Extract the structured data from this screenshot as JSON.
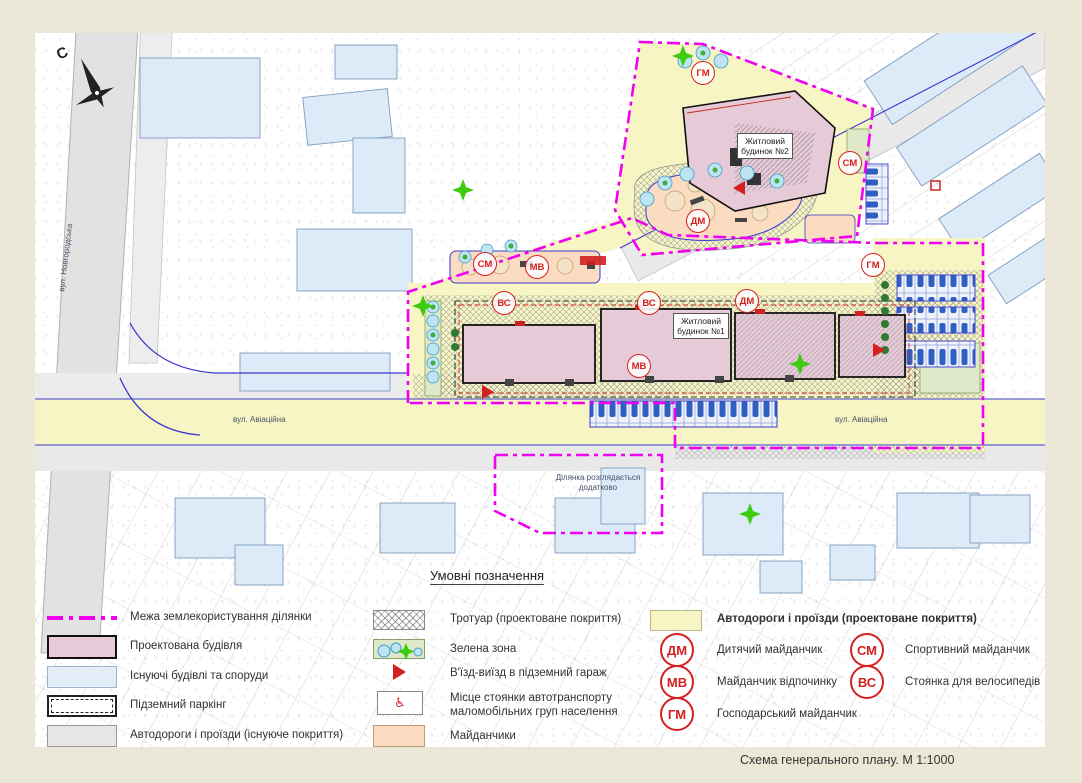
{
  "page": {
    "caption": "Схема  генерального плану. М 1:1000"
  },
  "map": {
    "compass_north": "С",
    "streets": {
      "novgorodska": "вул. Новгородська",
      "aviatsiina_left": "вул. Авіаційна",
      "aviatsiina_right": "вул. Авіаційна"
    },
    "buildings": {
      "house1": "Житловий будинок №1",
      "house2": "Житловий будинок №2"
    },
    "extra_parcel_note": "Ділянка розглядається додатково",
    "badges": [
      {
        "code": "СМ"
      },
      {
        "code": "МВ"
      },
      {
        "code": "ДМ"
      },
      {
        "code": "ГМ"
      },
      {
        "code": "СМ"
      },
      {
        "code": "ВС"
      },
      {
        "code": "ВС"
      },
      {
        "code": "ДМ"
      },
      {
        "code": "МВ"
      },
      {
        "code": "ГМ"
      }
    ]
  },
  "legend": {
    "title": "Умовні позначення",
    "col1": [
      {
        "label": "Межа землекористування ділянки"
      },
      {
        "label": "Проектована будівля"
      },
      {
        "label": "Існуючі будівлі та споруди"
      },
      {
        "label": "Підземний паркінг"
      },
      {
        "label": "Автодороги і проїзди (існуюче покриття)"
      }
    ],
    "col2": [
      {
        "label": "Тротуар (проектоване покриття)"
      },
      {
        "label": "Зелена зона"
      },
      {
        "label": "В'їзд-виїзд в підземний гараж"
      },
      {
        "label": "Місце стоянки автотранспорту маломобільних груп населення"
      },
      {
        "label": "Майданчики"
      }
    ],
    "road_projected": {
      "label": "Автодороги і проїзди (проектоване покриття)"
    },
    "wheelchair_symbol": "♿",
    "badges": [
      {
        "code": "ДМ",
        "label": "Дитячий майданчик"
      },
      {
        "code": "МВ",
        "label": "Майданчик відпочинку"
      },
      {
        "code": "ГМ",
        "label": "Господарський майданчик"
      },
      {
        "code": "СМ",
        "label": "Спортивний майданчик"
      },
      {
        "code": "ВС",
        "label": "Стоянка для велосипедів"
      }
    ]
  }
}
